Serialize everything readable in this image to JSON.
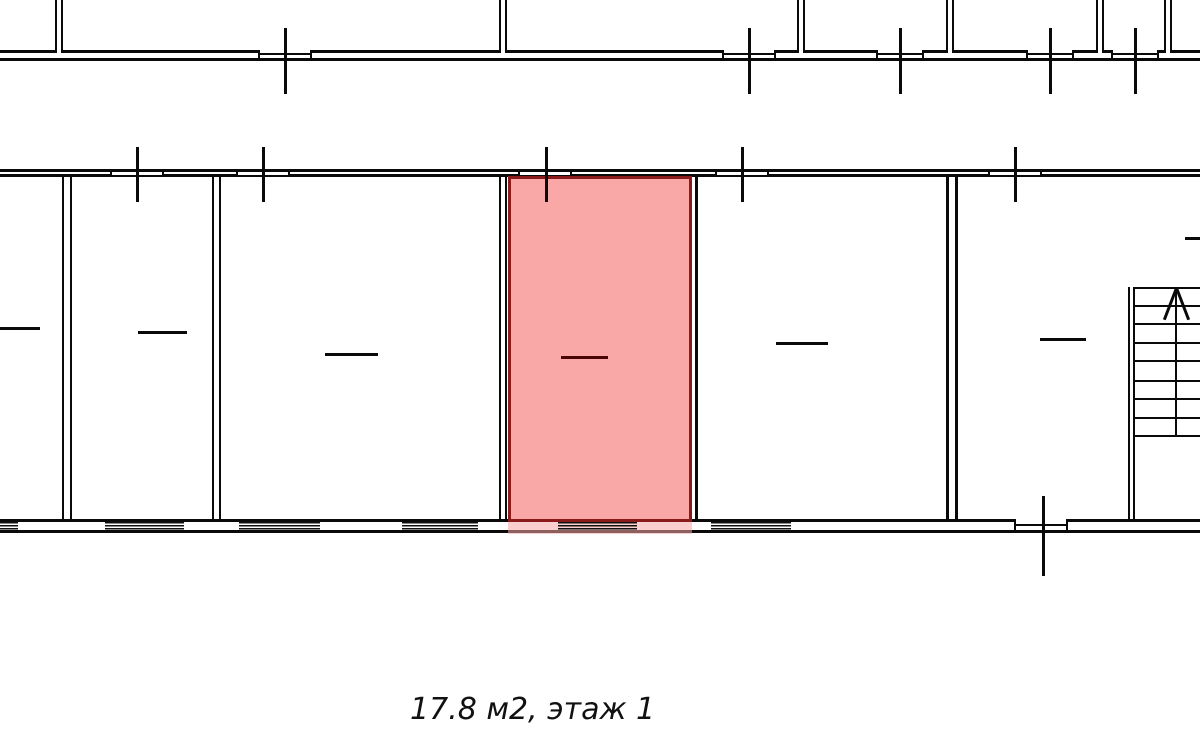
{
  "caption": "17.8 м2, этаж 1",
  "caption_pos": {
    "x": 410,
    "y": 692,
    "size": 30
  },
  "colors": {
    "background": "#ffffff",
    "wall": "#0a0a0a",
    "highlight_fill": "#faa7a7",
    "highlight_shadow": "rgba(250,167,167,0.55)",
    "highlight_border": "#8b1a1a",
    "highlight_dash": "#4a0505"
  },
  "plan": {
    "width": 1200,
    "height": 745,
    "hlines": [
      {
        "n": "upper-facade-outer-wall",
        "x": 0,
        "y": 58,
        "w": 1200,
        "t": 3
      },
      {
        "n": "upper-facade-inner-wall",
        "x": 0,
        "y": 50,
        "w": 55,
        "t": 3
      },
      {
        "n": "upper-facade-inner-wall",
        "x": 63,
        "y": 50,
        "w": 195,
        "t": 3
      },
      {
        "n": "upper-facade-inner-wall",
        "x": 312,
        "y": 50,
        "w": 187,
        "t": 3
      },
      {
        "n": "upper-facade-inner-wall",
        "x": 507,
        "y": 50,
        "w": 215,
        "t": 3
      },
      {
        "n": "upper-facade-inner-wall",
        "x": 776,
        "y": 50,
        "w": 21,
        "t": 3
      },
      {
        "n": "upper-facade-inner-wall",
        "x": 805,
        "y": 50,
        "w": 71,
        "t": 3
      },
      {
        "n": "upper-facade-inner-wall",
        "x": 924,
        "y": 50,
        "w": 22,
        "t": 3
      },
      {
        "n": "upper-facade-inner-wall",
        "x": 954,
        "y": 50,
        "w": 72,
        "t": 3
      },
      {
        "n": "upper-facade-inner-wall",
        "x": 1074,
        "y": 50,
        "w": 22,
        "t": 3
      },
      {
        "n": "upper-facade-inner-wall",
        "x": 1104,
        "y": 50,
        "w": 7,
        "t": 3
      },
      {
        "n": "upper-facade-inner-wall",
        "x": 1159,
        "y": 50,
        "w": 5,
        "t": 3
      },
      {
        "n": "upper-facade-inner-wall",
        "x": 1172,
        "y": 50,
        "w": 28,
        "t": 3
      },
      {
        "n": "upper-window-sill",
        "x": 258,
        "y": 53,
        "w": 54,
        "t": 1.5
      },
      {
        "n": "upper-window-sill",
        "x": 722,
        "y": 53,
        "w": 54,
        "t": 1.5
      },
      {
        "n": "upper-window-sill",
        "x": 876,
        "y": 53,
        "w": 48,
        "t": 1.5
      },
      {
        "n": "upper-window-sill",
        "x": 1026,
        "y": 53,
        "w": 48,
        "t": 1.5
      },
      {
        "n": "upper-window-sill",
        "x": 1111,
        "y": 53,
        "w": 48,
        "t": 1.5
      },
      {
        "n": "main-top-outer-wall",
        "x": 0,
        "y": 169,
        "w": 1200,
        "t": 3
      },
      {
        "n": "main-top-inner-wall",
        "x": 0,
        "y": 174,
        "w": 110,
        "t": 3
      },
      {
        "n": "main-top-inner-wall",
        "x": 164,
        "y": 174,
        "w": 72,
        "t": 3
      },
      {
        "n": "main-top-inner-wall",
        "x": 290,
        "y": 174,
        "w": 228,
        "t": 3
      },
      {
        "n": "main-top-inner-wall",
        "x": 572,
        "y": 174,
        "w": 143,
        "t": 3
      },
      {
        "n": "main-top-inner-wall",
        "x": 769,
        "y": 174,
        "w": 219,
        "t": 3
      },
      {
        "n": "main-top-inner-wall",
        "x": 1042,
        "y": 174,
        "w": 158,
        "t": 3
      },
      {
        "n": "main-top-window-sill",
        "x": 110,
        "y": 175,
        "w": 54,
        "t": 1.5
      },
      {
        "n": "main-top-window-sill",
        "x": 236,
        "y": 175,
        "w": 54,
        "t": 1.5
      },
      {
        "n": "main-top-window-sill",
        "x": 518,
        "y": 175,
        "w": 54,
        "t": 1.5
      },
      {
        "n": "main-top-window-sill",
        "x": 715,
        "y": 175,
        "w": 54,
        "t": 1.5
      },
      {
        "n": "main-top-window-sill",
        "x": 988,
        "y": 175,
        "w": 54,
        "t": 1.5
      },
      {
        "n": "main-bottom-inner-wall",
        "x": 0,
        "y": 519,
        "w": 1015,
        "t": 3
      },
      {
        "n": "main-bottom-inner-wall",
        "x": 1068,
        "y": 519,
        "w": 132,
        "t": 3
      },
      {
        "n": "door-threshold",
        "x": 1015,
        "y": 524,
        "w": 53,
        "t": 1.5
      },
      {
        "n": "main-bottom-outer-wall",
        "x": 0,
        "y": 530,
        "w": 1200,
        "t": 3
      }
    ],
    "vlines": [
      {
        "n": "interior-wall-line",
        "x": 695,
        "y": 176,
        "h": 345,
        "t": 3
      },
      {
        "n": "door-jamb",
        "x": 1014,
        "y": 519,
        "h": 13,
        "t": 2
      },
      {
        "n": "door-jamb",
        "x": 1066,
        "y": 519,
        "h": 13,
        "t": 2
      }
    ],
    "jamb_groups": [
      {
        "y": 169,
        "h": 8,
        "t": 2,
        "xs": [
          110,
          162,
          236,
          288,
          518,
          570,
          715,
          767,
          988,
          1040
        ]
      },
      {
        "y": 50,
        "h": 11,
        "t": 2,
        "xs": [
          258,
          310,
          722,
          774,
          876,
          922,
          1026,
          1072,
          1111,
          1157
        ]
      }
    ],
    "ticks": [
      {
        "n": "upper-section-tick",
        "x": 284,
        "y": 28,
        "h": 66,
        "t": 3
      },
      {
        "n": "upper-section-tick",
        "x": 748,
        "y": 28,
        "h": 66,
        "t": 3
      },
      {
        "n": "upper-section-tick",
        "x": 899,
        "y": 28,
        "h": 66,
        "t": 3
      },
      {
        "n": "upper-section-tick",
        "x": 1049,
        "y": 28,
        "h": 66,
        "t": 3
      },
      {
        "n": "upper-section-tick",
        "x": 1134,
        "y": 28,
        "h": 66,
        "t": 3
      },
      {
        "n": "main-top-section-tick",
        "x": 136,
        "y": 147,
        "h": 55,
        "t": 3
      },
      {
        "n": "main-top-section-tick",
        "x": 262,
        "y": 147,
        "h": 55,
        "t": 3
      },
      {
        "n": "main-top-section-tick",
        "x": 545,
        "y": 147,
        "h": 55,
        "t": 3
      },
      {
        "n": "main-top-section-tick",
        "x": 741,
        "y": 147,
        "h": 55,
        "t": 3
      },
      {
        "n": "main-top-section-tick",
        "x": 1014,
        "y": 147,
        "h": 55,
        "t": 3
      },
      {
        "n": "main-bottom-section-tick",
        "x": 1042,
        "y": 496,
        "h": 80,
        "t": 3
      }
    ],
    "dwalls": [
      {
        "n": "upper-partition-wall",
        "x": 55,
        "y": 0,
        "w": 8,
        "h": 53,
        "t": 2.5
      },
      {
        "n": "upper-partition-wall",
        "x": 499,
        "y": 0,
        "w": 8,
        "h": 53,
        "t": 2.5
      },
      {
        "n": "upper-partition-wall",
        "x": 797,
        "y": 0,
        "w": 8,
        "h": 53,
        "t": 2.5
      },
      {
        "n": "upper-partition-wall",
        "x": 946,
        "y": 0,
        "w": 8,
        "h": 53,
        "t": 2.5
      },
      {
        "n": "upper-partition-wall",
        "x": 1096,
        "y": 0,
        "w": 8,
        "h": 53,
        "t": 2.5
      },
      {
        "n": "upper-partition-wall",
        "x": 1164,
        "y": 0,
        "w": 8,
        "h": 53,
        "t": 2.5
      },
      {
        "n": "room-partition-wall",
        "x": 62,
        "y": 176,
        "w": 10,
        "h": 345,
        "t": 2.5
      },
      {
        "n": "room-partition-wall",
        "x": 212,
        "y": 176,
        "w": 9,
        "h": 345,
        "t": 2.5
      },
      {
        "n": "room-partition-wall",
        "x": 499,
        "y": 176,
        "w": 8,
        "h": 345,
        "t": 2.5
      },
      {
        "n": "room-partition-wall",
        "x": 946,
        "y": 176,
        "w": 12,
        "h": 345,
        "t": 3
      },
      {
        "n": "stairwell-wall",
        "x": 1128,
        "y": 287,
        "w": 7,
        "h": 234,
        "t": 2
      }
    ],
    "hatches": {
      "y": 522,
      "h": 8,
      "segs": [
        {
          "x": 0,
          "w": 18
        },
        {
          "x": 105,
          "w": 79
        },
        {
          "x": 239,
          "w": 81
        },
        {
          "x": 402,
          "w": 76
        },
        {
          "x": 558,
          "w": 79
        },
        {
          "x": 711,
          "w": 80
        }
      ]
    },
    "highlight": {
      "x": 508,
      "y": 176,
      "w": 184,
      "h": 346,
      "t": 3,
      "shadow": {
        "x": 508,
        "y": 521,
        "w": 184,
        "h": 13
      }
    },
    "dashes": [
      {
        "n": "room-dash",
        "x": 0,
        "y": 327,
        "w": 40,
        "t": 3
      },
      {
        "n": "room-dash",
        "x": 138,
        "y": 331,
        "w": 49,
        "t": 3
      },
      {
        "n": "room-dash",
        "x": 325,
        "y": 353,
        "w": 53,
        "t": 3
      },
      {
        "n": "highlighted-room-dash",
        "x": 561,
        "y": 356,
        "w": 47,
        "t": 3,
        "hl": true
      },
      {
        "n": "room-dash",
        "x": 776,
        "y": 342,
        "w": 52,
        "t": 3
      },
      {
        "n": "room-dash",
        "x": 1040,
        "y": 338,
        "w": 46,
        "t": 3
      },
      {
        "n": "room-dash",
        "x": 1185,
        "y": 237,
        "w": 15,
        "t": 3
      }
    ],
    "stairs": {
      "x": 1135,
      "w": 65,
      "t": 2,
      "steps_y": [
        287,
        305,
        323,
        342,
        360,
        380,
        398,
        417,
        435
      ],
      "divider": {
        "x": 1175,
        "y": 287,
        "h": 148,
        "t": 2
      },
      "arrow": {
        "x": 1176,
        "y": 288,
        "len": 34,
        "t": 3,
        "spread": 21
      }
    }
  }
}
